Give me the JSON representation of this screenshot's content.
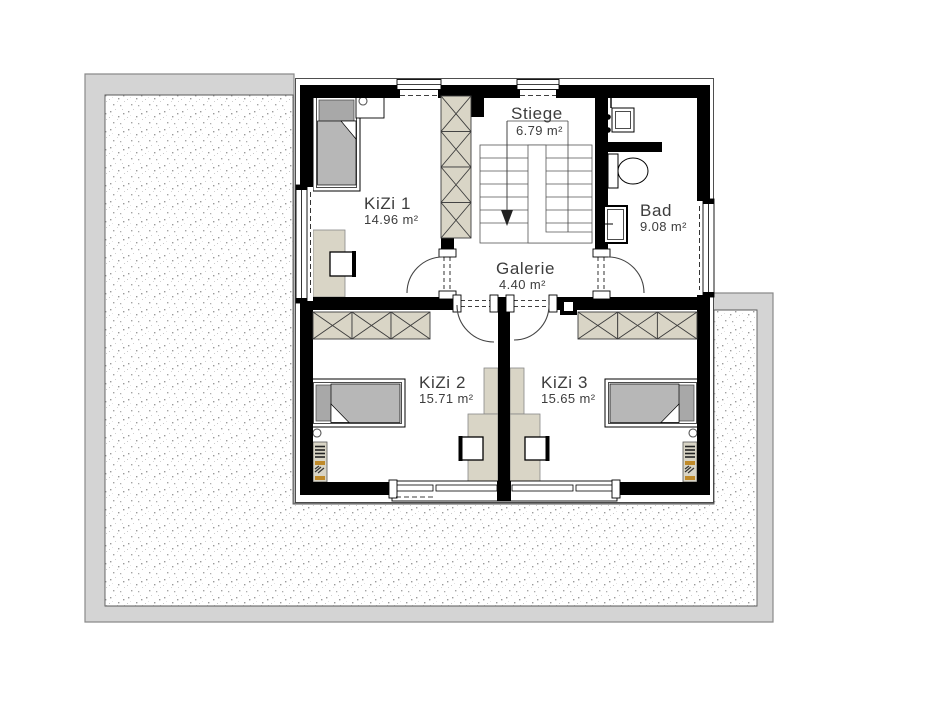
{
  "rooms": [
    {
      "name": "KiZi 1",
      "area": "14.96 m²"
    },
    {
      "name": "Stiege",
      "area": "6.79 m²"
    },
    {
      "name": "Bad",
      "area": "9.08 m²"
    },
    {
      "name": "Galerie",
      "area": "4.40 m²"
    },
    {
      "name": "KiZi 2",
      "area": "15.71 m²"
    },
    {
      "name": "KiZi 3",
      "area": "15.65 m²"
    }
  ],
  "colors": {
    "wall": "#000000",
    "roof_band": "#d4d4d4",
    "terrace_dot": "#9a9a9a",
    "furniture_tan": "#d9d5c6",
    "mattress_gray": "#b7b7b7",
    "pillow_gray": "#a8a8a8",
    "accent_orange": "#bf8a2a",
    "label_text": "#3d3d3d"
  }
}
